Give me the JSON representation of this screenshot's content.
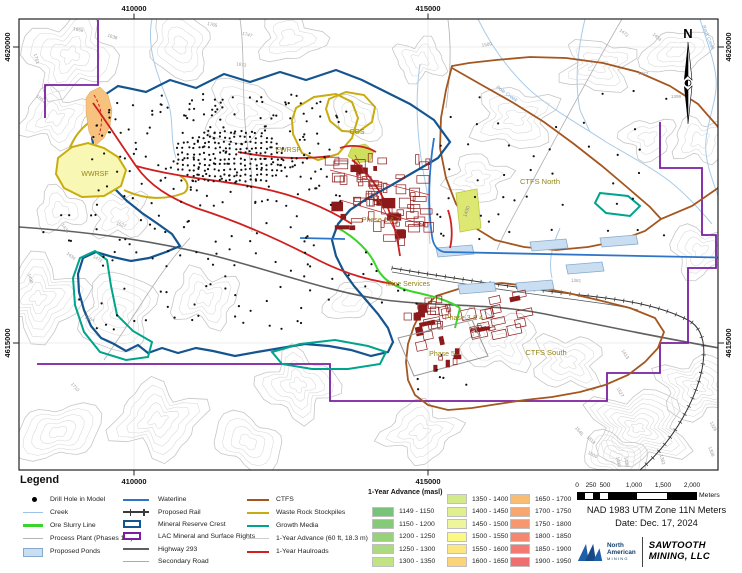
{
  "page": {
    "width": 742,
    "height": 573
  },
  "map": {
    "north_label": "N",
    "grid": {
      "top": [
        "410000",
        "415000"
      ],
      "bottom": [
        "410000",
        "415000"
      ],
      "left": [
        "4620000",
        "4615000"
      ],
      "right": [
        "4620000",
        "4615000"
      ]
    },
    "area_labels": [
      {
        "text": "WWRSF",
        "x": 95,
        "y": 176
      },
      {
        "text": "EWRSF",
        "x": 288,
        "y": 152
      },
      {
        "text": "CGS",
        "x": 357,
        "y": 134
      },
      {
        "text": "CTFS North",
        "x": 540,
        "y": 184
      },
      {
        "text": "CTFS South",
        "x": 546,
        "y": 355
      },
      {
        "text": "Phase 1 & 2",
        "x": 381,
        "y": 222
      },
      {
        "text": "Phase 3 & 4",
        "x": 464,
        "y": 320
      },
      {
        "text": "Phase 5",
        "x": 442,
        "y": 356
      },
      {
        "text": "Mine Services",
        "x": 408,
        "y": 286
      }
    ],
    "creek_labels": [
      {
        "text": "Pole Creek",
        "x": 506,
        "y": 95,
        "rot": 35
      },
      {
        "text": "Rock Creek",
        "x": 707,
        "y": 38,
        "rot": 68
      }
    ],
    "annotation_labels": [
      {
        "text": "1430",
        "x": 468,
        "y": 212,
        "rot": -72
      }
    ],
    "contour_labels": [
      {
        "text": "1765",
        "x": 212,
        "y": 26,
        "rot": 12
      },
      {
        "text": "1747",
        "x": 247,
        "y": 36,
        "rot": 15
      },
      {
        "text": "1673",
        "x": 241,
        "y": 66,
        "rot": 8
      },
      {
        "text": "1658",
        "x": 78,
        "y": 31,
        "rot": 12
      },
      {
        "text": "1638",
        "x": 112,
        "y": 38,
        "rot": 18
      },
      {
        "text": "1763",
        "x": 35,
        "y": 59,
        "rot": 75
      },
      {
        "text": "1601",
        "x": 40,
        "y": 100,
        "rot": 35
      },
      {
        "text": "1509",
        "x": 487,
        "y": 46,
        "rot": -8
      },
      {
        "text": "1472",
        "x": 623,
        "y": 34,
        "rot": 38
      },
      {
        "text": "1454",
        "x": 656,
        "y": 38,
        "rot": 42
      },
      {
        "text": "1472",
        "x": 643,
        "y": 75,
        "rot": 5
      },
      {
        "text": "1399",
        "x": 676,
        "y": 98,
        "rot": 0
      },
      {
        "text": "1381",
        "x": 576,
        "y": 282,
        "rot": 3
      },
      {
        "text": "1436",
        "x": 64,
        "y": 229,
        "rot": 55
      },
      {
        "text": "1434",
        "x": 70,
        "y": 257,
        "rot": 40
      },
      {
        "text": "1472",
        "x": 97,
        "y": 260,
        "rot": 28
      },
      {
        "text": "1490",
        "x": 29,
        "y": 279,
        "rot": 72
      },
      {
        "text": "1564",
        "x": 89,
        "y": 320,
        "rot": 22
      },
      {
        "text": "1710",
        "x": 74,
        "y": 388,
        "rot": 48
      },
      {
        "text": "1527",
        "x": 121,
        "y": 226,
        "rot": 18
      },
      {
        "text": "1413",
        "x": 624,
        "y": 355,
        "rot": 58
      },
      {
        "text": "1527",
        "x": 619,
        "y": 393,
        "rot": 60
      },
      {
        "text": "1545",
        "x": 578,
        "y": 432,
        "rot": 50
      },
      {
        "text": "1818",
        "x": 590,
        "y": 441,
        "rot": 42
      },
      {
        "text": "1600",
        "x": 592,
        "y": 456,
        "rot": 28
      },
      {
        "text": "1490",
        "x": 617,
        "y": 462,
        "rot": 80
      },
      {
        "text": "1436",
        "x": 625,
        "y": 462,
        "rot": 80
      },
      {
        "text": "1362",
        "x": 661,
        "y": 460,
        "rot": 75
      },
      {
        "text": "1326",
        "x": 712,
        "y": 427,
        "rot": 62
      },
      {
        "text": "1308",
        "x": 710,
        "y": 452,
        "rot": 70
      }
    ]
  },
  "legend": {
    "title": "Legend",
    "col1": [
      {
        "label": "Drill Hole in Model",
        "swatch": "dot",
        "color": "#000000"
      },
      {
        "label": "Creek",
        "swatch": "line",
        "weight": 1,
        "color": "#9dc3e6"
      },
      {
        "label": "Ore Slurry Line",
        "swatch": "line",
        "weight": 3,
        "color": "#3bd42a"
      },
      {
        "label": "Process Plant (Phases 1-5)",
        "swatch": "line",
        "weight": 1,
        "color": "#b5b5b5"
      },
      {
        "label": "Proposed Ponds",
        "swatch": "rect-fill",
        "color": "#c9def1",
        "stroke": "#85aacc"
      }
    ],
    "col2": [
      {
        "label": "Waterline",
        "swatch": "line",
        "weight": 2.5,
        "color": "#2e75c9"
      },
      {
        "label": "Proposed Rail",
        "swatch": "rail",
        "color": "#3a3a3a"
      },
      {
        "label": "Mineral Reserve Crest",
        "swatch": "rect-outline",
        "color": "#15558f"
      },
      {
        "label": "LAC Mineral and Surface Rights",
        "swatch": "rect-outline",
        "color": "#7a1fa0"
      },
      {
        "label": "Highway 293",
        "swatch": "line",
        "weight": 2,
        "color": "#5f5f5f"
      },
      {
        "label": "Secondary Road",
        "swatch": "line",
        "weight": 1,
        "color": "#ababab"
      }
    ],
    "col3": [
      {
        "label": "CTFS",
        "swatch": "line",
        "weight": 2.5,
        "color": "#a4561f"
      },
      {
        "label": "Waste Rock Stockpiles",
        "swatch": "line",
        "weight": 2.5,
        "color": "#c9ac10"
      },
      {
        "label": "Growth Media",
        "swatch": "line",
        "weight": 2.5,
        "color": "#00a48c"
      },
      {
        "label": "1-Year Advance (60 ft, 18.3 m)",
        "swatch": "line",
        "weight": 1,
        "color": "#cfcfcf"
      },
      {
        "label": "1-Year Haulroads",
        "swatch": "line",
        "weight": 2.5,
        "color": "#cf1f1f"
      }
    ],
    "advance_header": "1-Year Advance (masl)",
    "advance_columns": [
      [
        {
          "label": "1149 - 1150",
          "color": "#77c379"
        },
        {
          "label": "1150 - 1200",
          "color": "#85ca79"
        },
        {
          "label": "1200 - 1250",
          "color": "#97d27b"
        },
        {
          "label": "1250 - 1300",
          "color": "#adda7f"
        },
        {
          "label": "1300 - 1350",
          "color": "#c2e384"
        }
      ],
      [
        {
          "label": "1350 - 1400",
          "color": "#d2ea8a"
        },
        {
          "label": "1400 - 1450",
          "color": "#e0f08f"
        },
        {
          "label": "1450 - 1500",
          "color": "#eef59b"
        },
        {
          "label": "1500 - 1550",
          "color": "#fbf884"
        },
        {
          "label": "1550 - 1600",
          "color": "#fce67f"
        },
        {
          "label": "1600 - 1650",
          "color": "#fbd378"
        }
      ],
      [
        {
          "label": "1650 - 1700",
          "color": "#f9bd72"
        },
        {
          "label": "1700 - 1750",
          "color": "#f7a76d"
        },
        {
          "label": "1750 - 1800",
          "color": "#f69770"
        },
        {
          "label": "1800 - 1850",
          "color": "#f4876f"
        },
        {
          "label": "1850 - 1900",
          "color": "#f27a72"
        },
        {
          "label": "1900 - 1950",
          "color": "#ef6f70"
        }
      ]
    ]
  },
  "scalebar": {
    "labels": [
      "0",
      "250",
      "500",
      "1,000",
      "1,500",
      "2,000"
    ],
    "unit": "Meters"
  },
  "notes": {
    "projection": "NAD 1983 UTM Zone 11N Meters",
    "date": "Date: Dec. 17, 2024"
  },
  "logos": {
    "na_name_line1": "North",
    "na_name_line2": "American",
    "na_sub": "MINING",
    "right_line1": "SAWTOOTH",
    "right_line2": "MINING, LLC"
  },
  "colors": {
    "crest": "#15558f",
    "lac_boundary": "#7a1fa0",
    "ctfs": "#a4561f",
    "waste_rock": "#c9ac10",
    "growth_media": "#00a48c",
    "haulroad": "#cf1f1f",
    "ore_slurry": "#3bd42a",
    "waterline": "#2e75c9",
    "creek": "#a8cbe8",
    "highway": "#606060",
    "secondary_road": "#b0b0b0",
    "rail": "#333333",
    "pond_fill": "#c9def1",
    "pond_stroke": "#85aacc",
    "building": "#8c1a1a",
    "area_label": "#968413",
    "wwrsf_fill": "#f9f7b4",
    "advance_band": "#f6c27d",
    "poly_1430_fill": "#dde873",
    "contour": "#d8d8d8"
  }
}
